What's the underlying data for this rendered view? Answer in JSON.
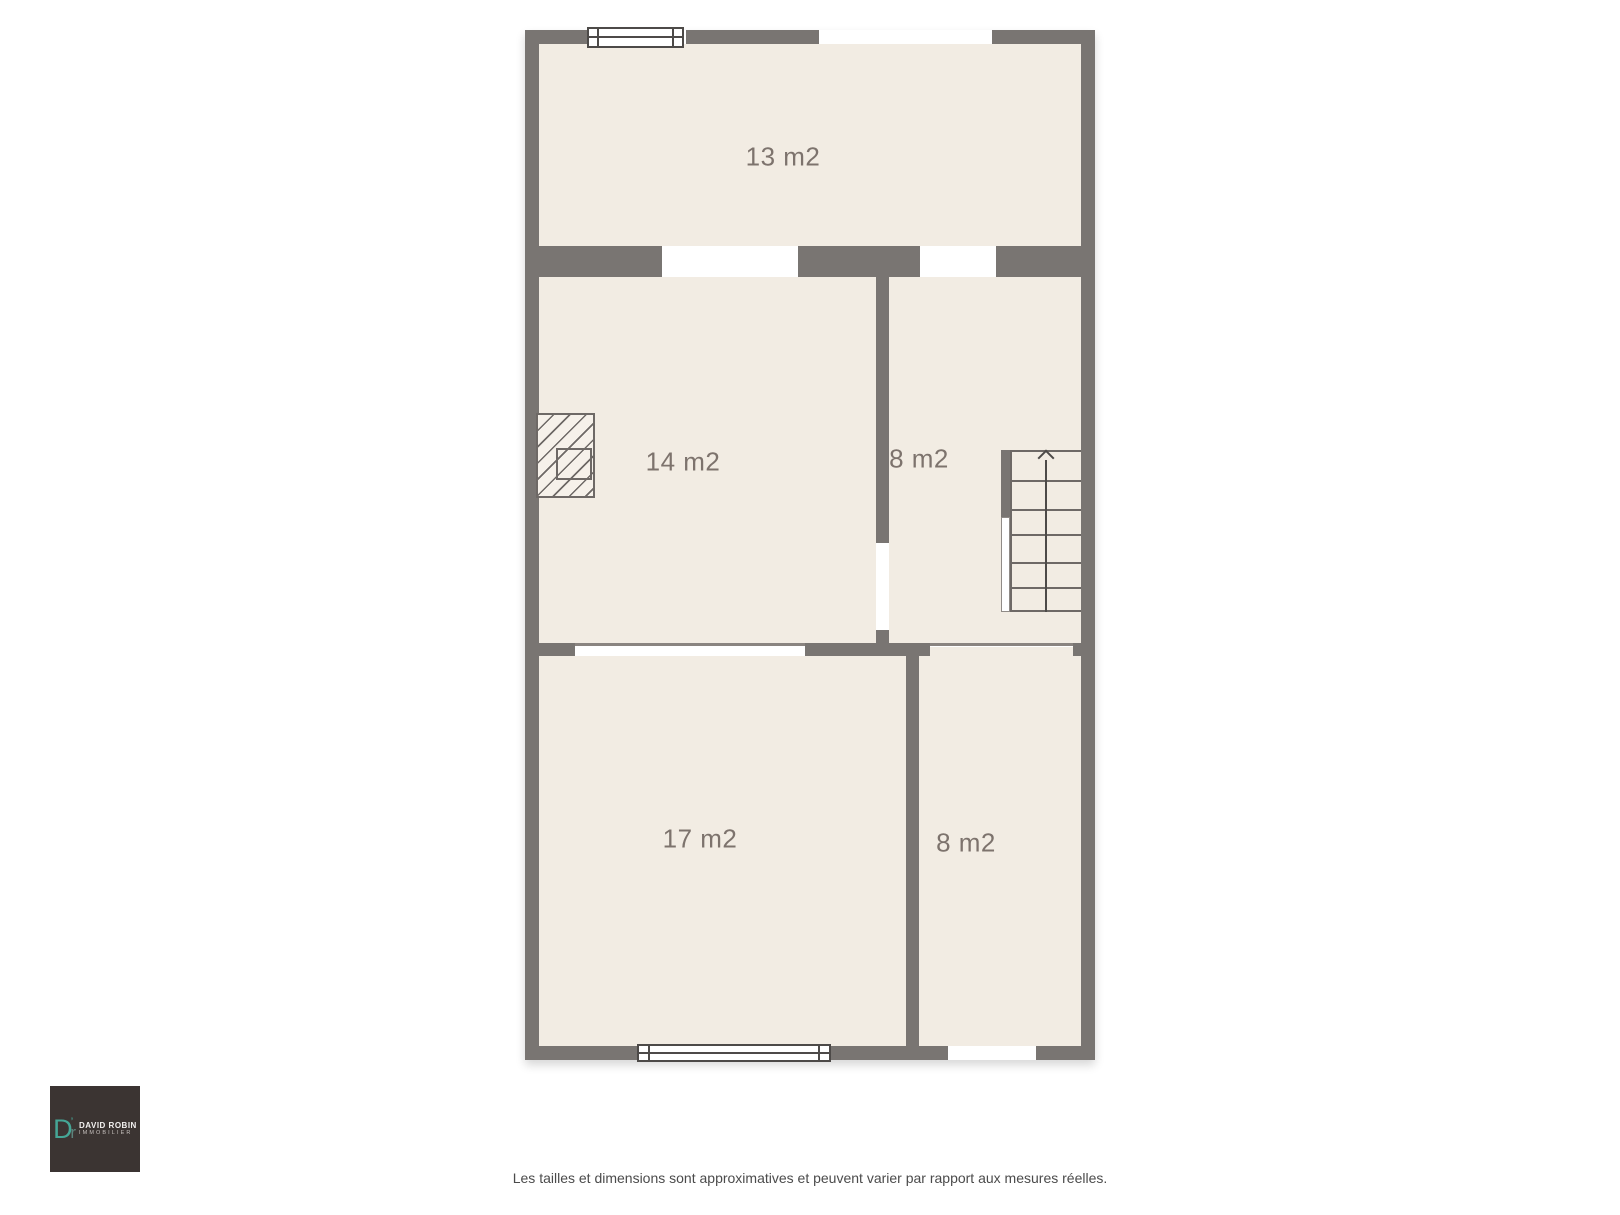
{
  "colors": {
    "wall": "#797572",
    "floor": "#f2ece3",
    "line": "#6e6966",
    "label": "#7d736d",
    "teal": "#45a696",
    "logo_bg": "#3b3432"
  },
  "plan": {
    "rooms": [
      {
        "name": "room-13",
        "label": "13 m2"
      },
      {
        "name": "room-14",
        "label": "14 m2"
      },
      {
        "name": "room-8-middle",
        "label": "8 m2"
      },
      {
        "name": "room-17",
        "label": "17 m2"
      },
      {
        "name": "room-8-bottom",
        "label": "8 m2"
      }
    ]
  },
  "logo": {
    "monogram_d": "D",
    "monogram_mark": "’",
    "monogram_r": "r",
    "name": "DAVID ROBIN",
    "subtitle": "IMMOBILIER"
  },
  "footer": {
    "disclaimer": "Les tailles et dimensions sont approximatives et peuvent varier par rapport aux mesures réelles."
  }
}
